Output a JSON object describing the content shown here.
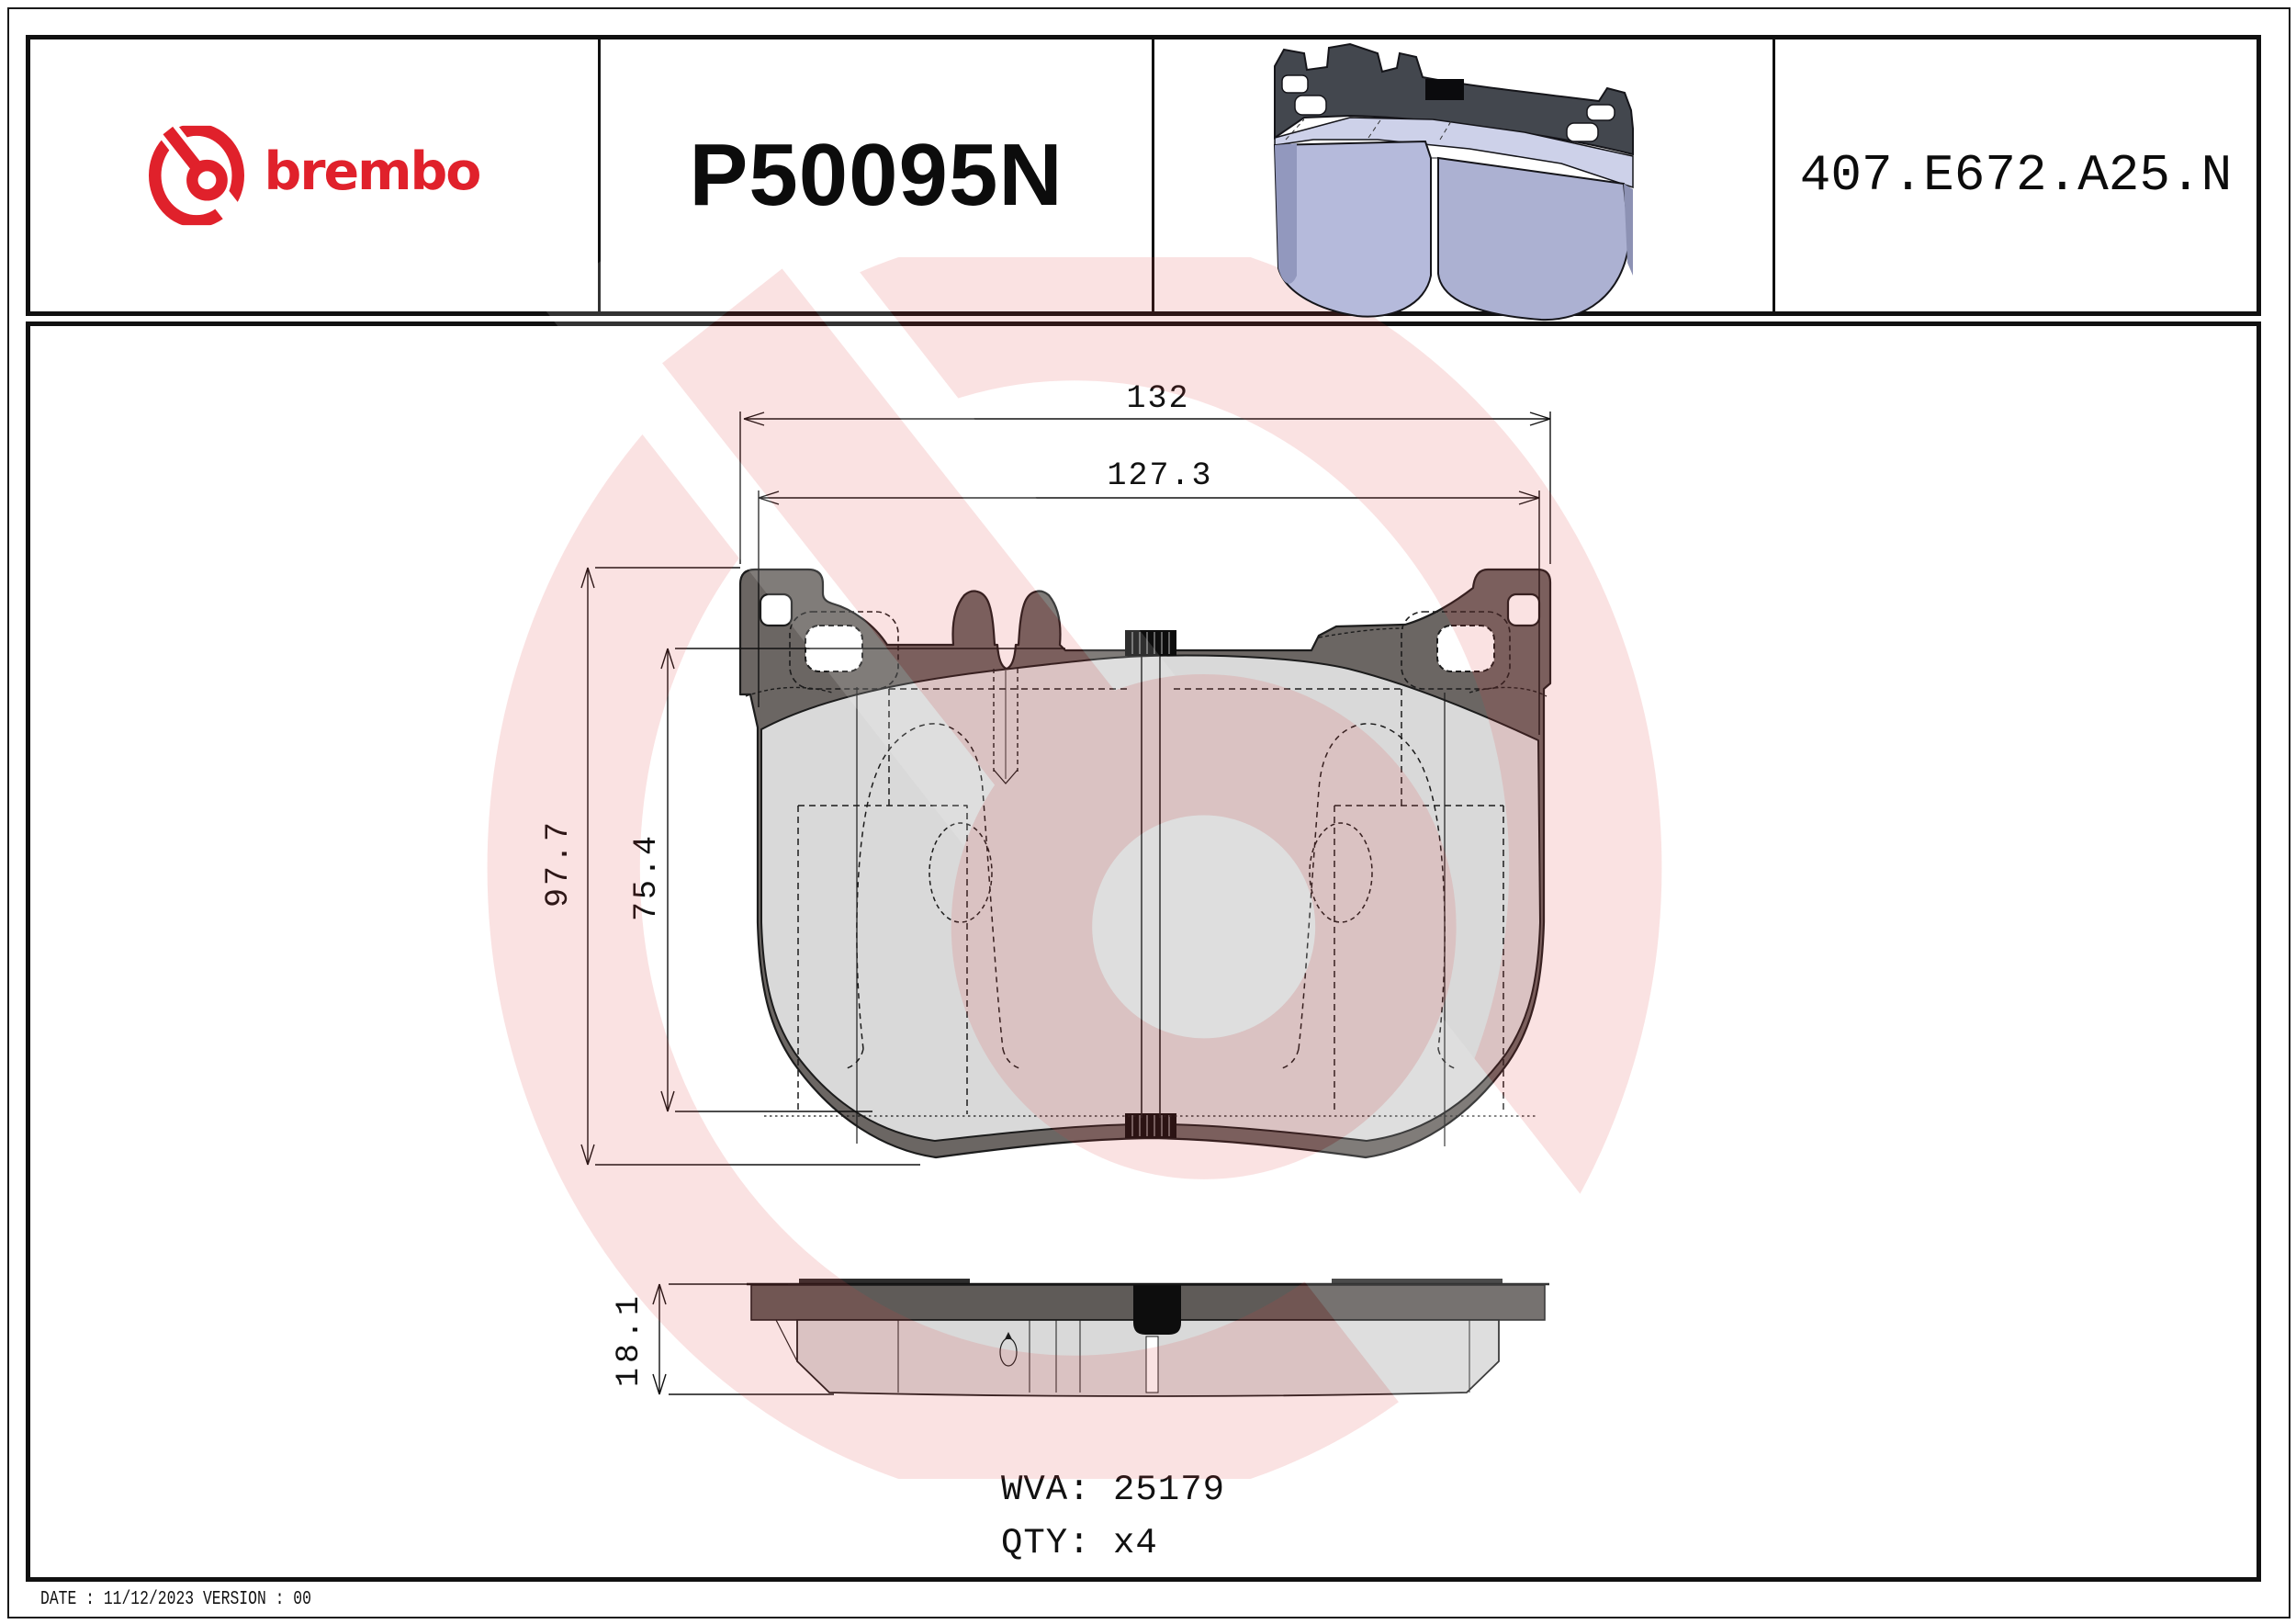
{
  "header": {
    "brand": "brembo",
    "part_number": "P50095N",
    "catalog_code": "407.E672.A25.N"
  },
  "drawing": {
    "dim_overall_width": "132",
    "dim_friction_width": "127.3",
    "dim_overall_height": "97.7",
    "dim_friction_height": "75.4",
    "dim_thickness": "18.1"
  },
  "product_info": {
    "wva_label": "WVA:",
    "wva_value": "25179",
    "qty_label": "QTY:",
    "qty_value": "x4"
  },
  "footer": {
    "date_label": "DATE :",
    "date_value": "11/12/2023",
    "version_label": "VERSION :",
    "version_value": "00"
  },
  "colors": {
    "brand_red": "#e0212b",
    "watermark_pink": "#f8dede",
    "backplate_gray": "#6b6663",
    "friction_gray": "#d9d9d9",
    "pad_render_blue": "#b5badb",
    "line_black": "#111111"
  }
}
